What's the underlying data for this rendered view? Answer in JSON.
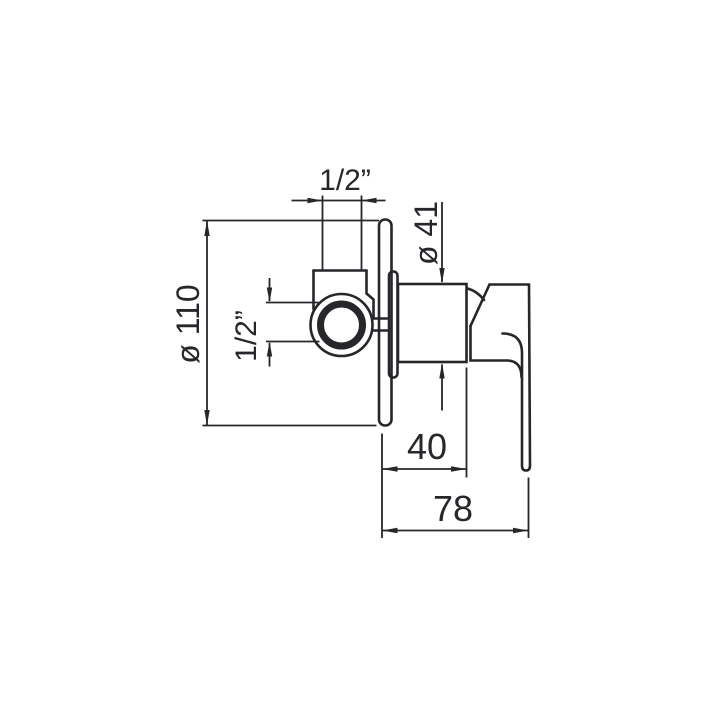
{
  "drawing": {
    "kind": "technical-dimension-drawing",
    "background": "#ffffff",
    "line_color": "#26262b",
    "labels": {
      "top_connection": "1/2”",
      "side_connection": "1/2”",
      "plate_diameter": "ø 110",
      "body_diameter": "ø 41",
      "body_depth": "40",
      "total_depth": "78"
    }
  }
}
